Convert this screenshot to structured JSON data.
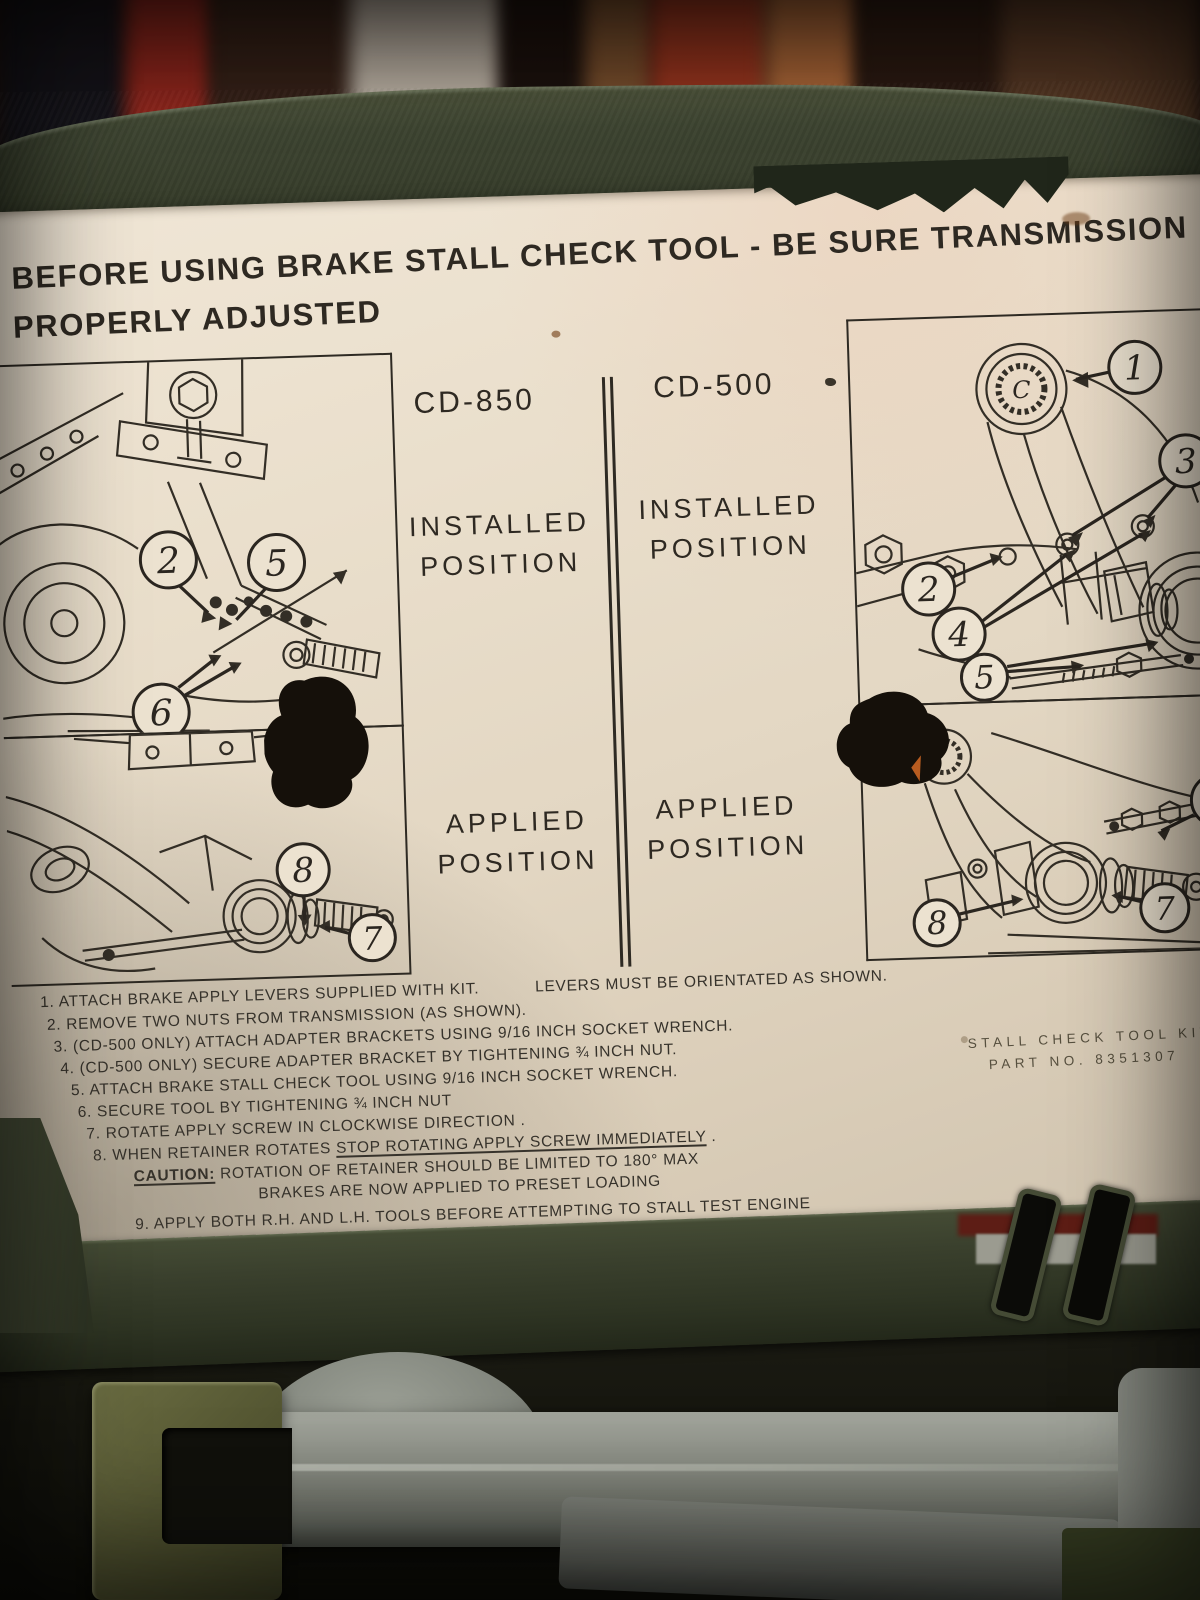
{
  "header": {
    "line1": "BEFORE USING BRAKE STALL CHECK TOOL - BE SURE TRANSMISSION",
    "line2": "PROPERLY ADJUSTED"
  },
  "columns": {
    "left_model": "CD-850",
    "right_model": "CD-500"
  },
  "position_labels": {
    "installed_line1": "INSTALLED",
    "installed_line2": "POSITION",
    "applied_line1": "APPLIED",
    "applied_line2": "POSITION"
  },
  "callouts": {
    "cd850_installed": [
      "2",
      "5",
      "6"
    ],
    "cd850_applied": [
      "8",
      "7"
    ],
    "cd500_installed": [
      "1",
      "3",
      "2",
      "4",
      "5"
    ],
    "cd500_applied": [
      "2",
      "7",
      "8"
    ],
    "cd500_lever_letter": "C"
  },
  "instructions": {
    "item1": "1. ATTACH BRAKE APPLY LEVERS SUPPLIED WITH KIT.",
    "item1_note": "LEVERS MUST BE ORIENTATED AS SHOWN.",
    "item2": "2. REMOVE TWO NUTS FROM TRANSMISSION (AS SHOWN).",
    "item3": "3. (CD-500 ONLY) ATTACH ADAPTER BRACKETS USING 9/16 INCH SOCKET WRENCH.",
    "item4": "4. (CD-500 ONLY) SECURE ADAPTER BRACKET BY TIGHTENING  ¾  INCH NUT.",
    "item5": "5. ATTACH BRAKE STALL CHECK TOOL USING 9/16 INCH SOCKET WRENCH.",
    "item6": "6. SECURE TOOL BY TIGHTENING ¾ INCH NUT",
    "item7": "7. ROTATE APPLY SCREW IN CLOCKWISE DIRECTION .",
    "item8_pre": "8. WHEN RETAINER ROTATES ",
    "item8_underline": "STOP ROTATING APPLY SCREW IMMEDIATELY",
    "item8_post": " .",
    "caution_label": "CAUTION:",
    "caution_rest": " ROTATION OF RETAINER SHOULD BE  LIMITED TO 180° MAX",
    "caution_line2": "BRAKES ARE NOW APPLIED TO PRESET LOADING",
    "item9": "9. APPLY BOTH R.H. AND L.H. TOOLS BEFORE ATTEMPTING TO STALL TEST ENGINE",
    "item10": "10. REMOVE TOOL BY REVERSING THE NUMBERED PROCESS."
  },
  "kit": {
    "line1": "STALL CHECK TOOL KIT",
    "line2": "PART NO. 8351307"
  },
  "colors": {
    "case_olive": "#3a4130",
    "case_olive_light": "#4d5440",
    "label_cream": "#e8ddc9",
    "ink": "#2b2620",
    "tool_gray": "#8a8d85",
    "shelf_red": "#a2291f",
    "shelf_orange": "#c4753f"
  }
}
